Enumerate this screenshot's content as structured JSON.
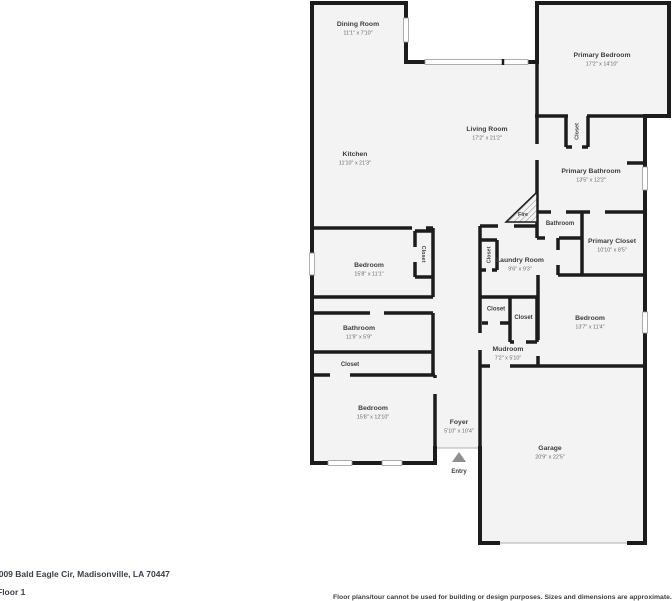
{
  "rooms": {
    "dining": {
      "name": "Dining Room",
      "dims": "11'1\" x 7'10\""
    },
    "kitchen": {
      "name": "Kitchen",
      "dims": "11'10\" x 21'3\""
    },
    "living": {
      "name": "Living Room",
      "dims": "17'2\" x 21'2\""
    },
    "primary_bedroom": {
      "name": "Primary Bedroom",
      "dims": "17'2\" x 14'10\""
    },
    "primary_bathroom": {
      "name": "Primary Bathroom",
      "dims": "13'5\" x 12'2\""
    },
    "bathroom_small": {
      "name": "Bathroom"
    },
    "primary_closet": {
      "name": "Primary Closet",
      "dims": "10'10\" x 8'5\""
    },
    "laundry": {
      "name": "Laundry Room",
      "dims": "9'6\" x 9'3\""
    },
    "bedroom_1": {
      "name": "Bedroom",
      "dims": "15'8\" x 11'1\""
    },
    "bathroom_2": {
      "name": "Bathroom",
      "dims": "11'9\" x 5'9\""
    },
    "bedroom_2": {
      "name": "Bedroom",
      "dims": "15'8\" x 12'10\""
    },
    "bedroom_3": {
      "name": "Bedroom",
      "dims": "13'7\" x 11'4\""
    },
    "mudroom": {
      "name": "Mudroom",
      "dims": "7'2\" x 5'10\""
    },
    "foyer": {
      "name": "Foyer",
      "dims": "5'10\" x 10'4\""
    },
    "garage": {
      "name": "Garage",
      "dims": "20'9\" x 22'5\""
    }
  },
  "markers": {
    "fire": "Fire",
    "entry": "Entry",
    "closet": "Closet"
  },
  "colors": {
    "wall": "#1c1c1c",
    "room_fill": "#f3f3f3",
    "label": "#3e3e3e",
    "dim_label": "#6a6a6a",
    "door_line": "#bdbdbd"
  },
  "footer": {
    "address": "7009 Bald Eagle Cir, Madisonville, LA 70447",
    "floor": "Floor 1",
    "disclaimer": "Floor plans/tour cannot be used for building or design purposes. Sizes and dimensions are approximate."
  }
}
